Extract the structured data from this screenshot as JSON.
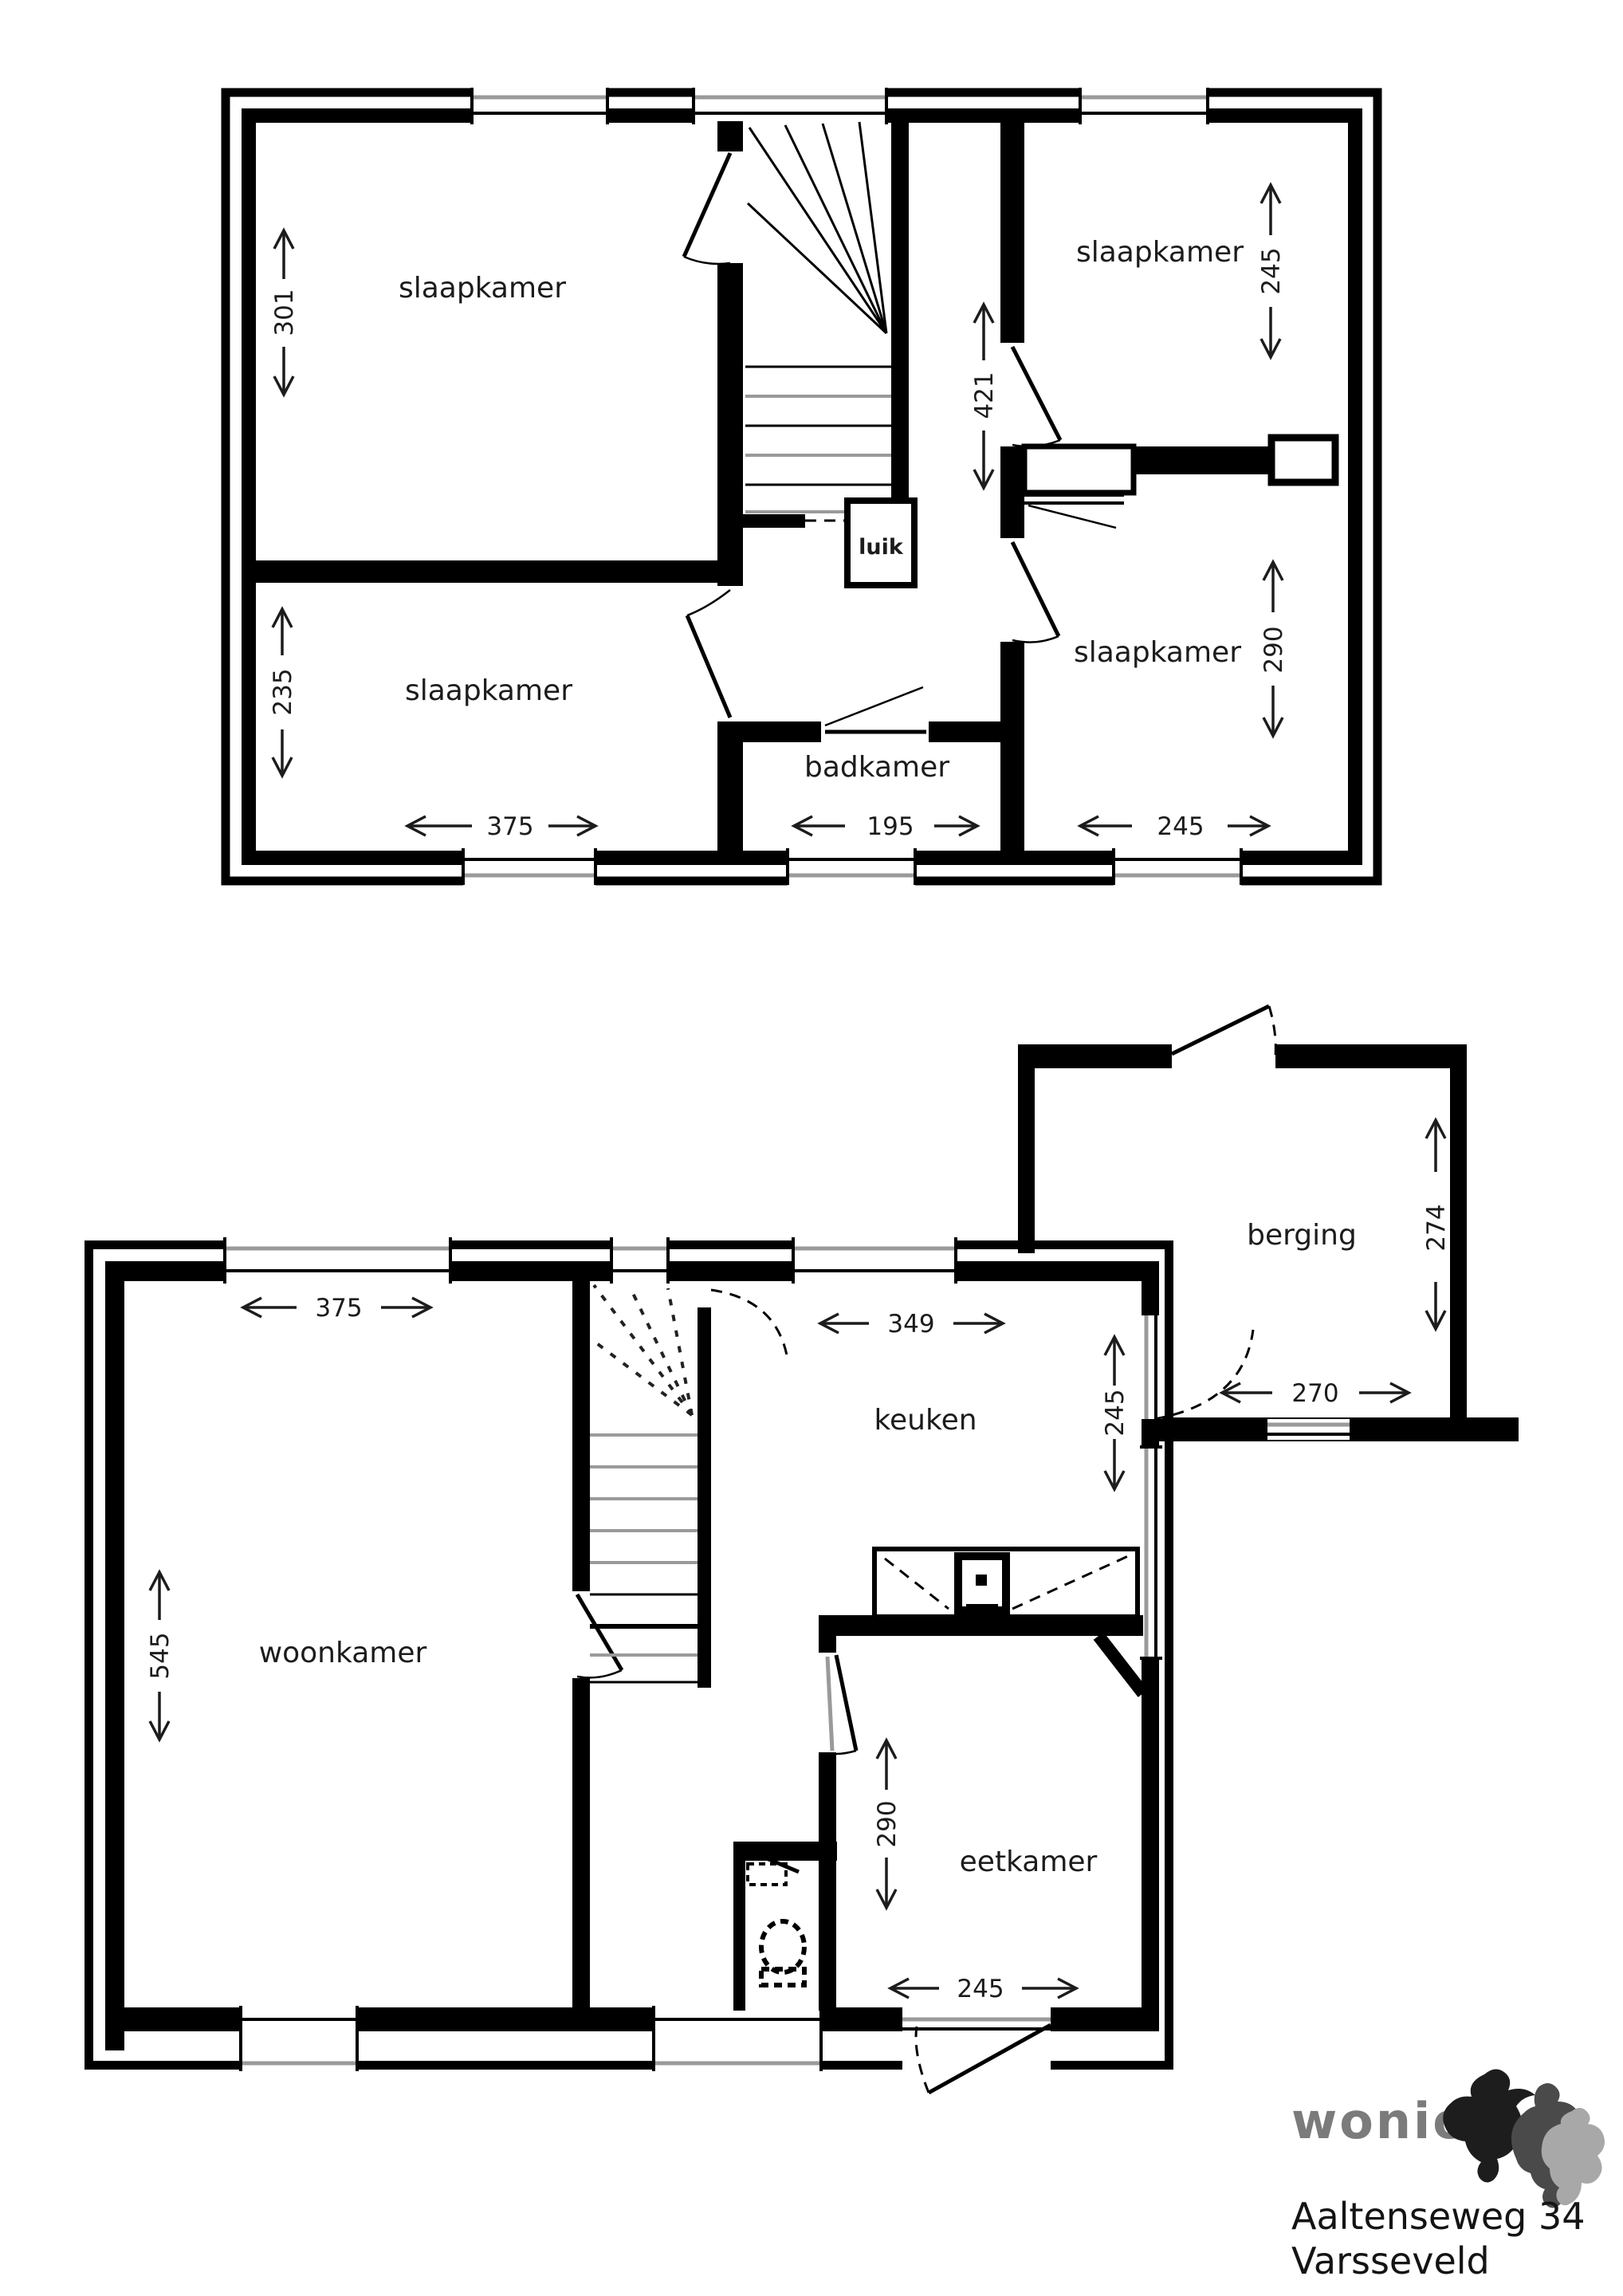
{
  "upper_floor": {
    "bedroom_top_left": {
      "label": "slaapkamer",
      "height_dim": "301"
    },
    "bedroom_bottom_left": {
      "label": "slaapkamer",
      "height_dim": "235",
      "width_dim": "375"
    },
    "bedroom_top_right": {
      "label": "slaapkamer",
      "height_dim": "245"
    },
    "bedroom_bottom_right": {
      "label": "slaapkamer",
      "height_dim": "290",
      "width_dim": "245"
    },
    "bathroom": {
      "label": "badkamer",
      "width_dim": "195"
    },
    "hall": {
      "length_dim": "421"
    },
    "hatch": {
      "label": "luik"
    }
  },
  "ground_floor": {
    "living_room": {
      "label": "woonkamer",
      "height_dim": "545",
      "width_dim": "375"
    },
    "kitchen": {
      "label": "keuken",
      "width_dim": "349",
      "height_dim": "245"
    },
    "dining_room": {
      "label": "eetkamer",
      "height_dim": "290",
      "width_dim": "245"
    },
    "storage": {
      "label": "berging",
      "height_dim": "274",
      "width_dim": "270"
    }
  },
  "footer": {
    "brand": "wonion",
    "address_line1": "Aaltenseweg 34",
    "address_line2": "Varsseveld",
    "brand_color": "#7b7b7b"
  }
}
